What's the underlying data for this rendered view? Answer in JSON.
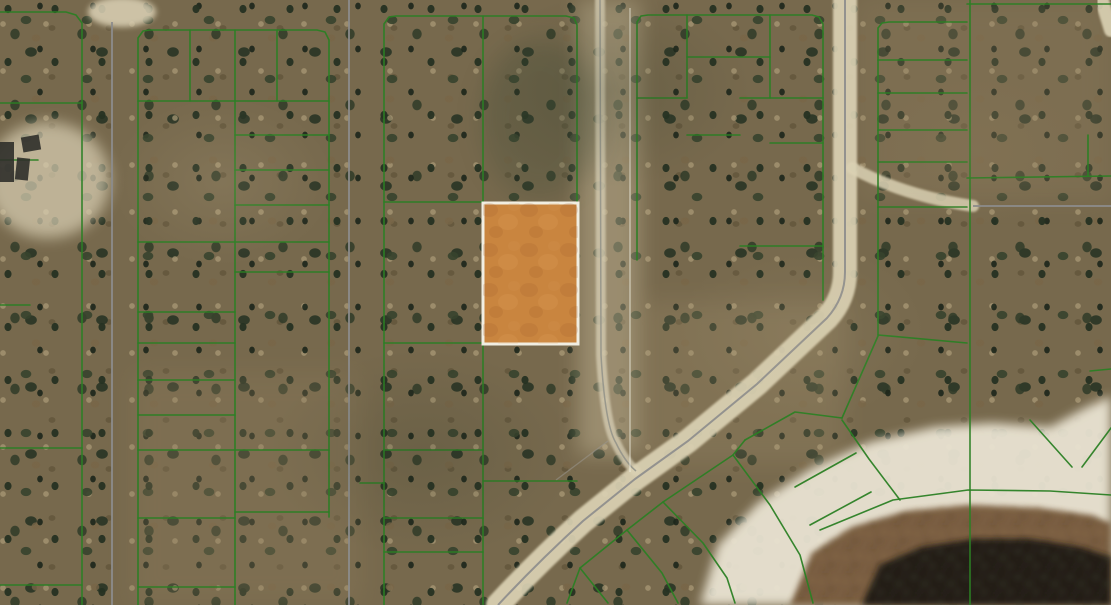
{
  "meta": {
    "view": "aerial-parcel-map",
    "description": "Satellite aerial view of a wooded subdivision with green platted lot boundaries, dirt roads, one orange highlighted parcel, and a dark pond at lower right",
    "width": 1111,
    "height": 605
  },
  "colors": {
    "parcel_line": "#2b7f24",
    "road_fill": "#dbd2b4",
    "road_centerline": "#8c8c8c",
    "highlight_fill": "#c9853f",
    "highlight_border": "#f1eee2",
    "sand": "#e9e3d2",
    "marsh": "#75593a",
    "pond": "#211c14",
    "section_line": "rgba(240,238,226,0.55)",
    "building": "#2f2f2a"
  },
  "map": {
    "highlight_parcel": {
      "x": 483,
      "y": 203,
      "width": 95,
      "height": 141,
      "fill": "#c9853f",
      "border": "#f1eee2",
      "border_width": 3,
      "texture": "tex-orange"
    },
    "terrain_zones": [
      {
        "shape": "ellipse",
        "cx": 48,
        "cy": 180,
        "rx": 62,
        "ry": 58,
        "fill": "#dcd2b6",
        "opacity": 0.7,
        "blur": 7
      },
      {
        "shape": "ellipse",
        "cx": 122,
        "cy": 12,
        "rx": 34,
        "ry": 15,
        "fill": "#dcd2b6",
        "opacity": 0.85,
        "blur": 3
      },
      {
        "shape": "rect",
        "x": 578,
        "y": 0,
        "w": 62,
        "h": 455,
        "fill": "#cfc2a2",
        "opacity": 0.4,
        "blur": 10
      },
      {
        "shape": "rect",
        "x": 132,
        "y": 372,
        "w": 230,
        "h": 233,
        "fill": "#8d7c5c",
        "opacity": 0.3,
        "blur": 12
      },
      {
        "shape": "rect",
        "x": 858,
        "y": 0,
        "w": 253,
        "h": 200,
        "fill": "#8f7e5f",
        "opacity": 0.26,
        "blur": 12
      },
      {
        "shape": "rect",
        "x": 640,
        "y": 300,
        "w": 205,
        "h": 165,
        "fill": "#a4936f",
        "opacity": 0.22,
        "blur": 12
      },
      {
        "shape": "ellipse",
        "cx": 540,
        "cy": 120,
        "rx": 60,
        "ry": 80,
        "fill": "#3c4a34",
        "opacity": 0.25,
        "blur": 12
      }
    ],
    "water_features": [
      {
        "name": "beach-sand",
        "points": "700,605 718,545 758,503 812,468 870,442 935,427 992,423 1050,427 1085,408 1111,396 1111,605",
        "fill": "#e9e3d2",
        "opacity": 0.95,
        "blur": 5
      },
      {
        "name": "marsh-ring",
        "points": "790,605 812,553 852,527 906,511 970,505 1040,508 1090,515 1111,523 1111,605",
        "fill": "#75593a",
        "opacity": 0.95,
        "blur": 3,
        "texture": "tex-marsh"
      },
      {
        "name": "pond-water",
        "points": "862,605 880,565 922,547 975,539 1030,539 1080,547 1111,557 1111,605",
        "fill": "#211c14",
        "opacity": 0.97,
        "blur": 3,
        "texture": "tex-pond"
      }
    ],
    "roads": {
      "bands": [
        {
          "name": "top-road",
          "d": "M 95,6 L 880,6",
          "w": 14
        },
        {
          "name": "left-road",
          "d": "M 113,0 L 113,605",
          "w": 24
        },
        {
          "name": "second-road",
          "d": "M 349,0 L 349,605",
          "w": 22
        },
        {
          "name": "trail-road",
          "d": "M 600,0 L 601,355 Q 605,425 616,443 Q 625,462 636,471",
          "w": 10,
          "color": "#d3cab0",
          "opacity": 0.8
        },
        {
          "name": "right-diagonal-road",
          "d": "M 845,0 L 845,272 Q 845,298 827,318 L 757,384 L 688,441 L 635,479 L 583,521 Q 538,562 498,605",
          "w": 24
        },
        {
          "name": "east-road",
          "d": "M 973,206 L 1111,206",
          "w": 16
        },
        {
          "name": "road-connector",
          "d": "M 852,168 Q 905,196 973,206",
          "w": 12,
          "opacity": 0.85
        },
        {
          "name": "corner-stub",
          "d": "M 1100,-6 Q 1106,14 1111,30",
          "w": 14,
          "opacity": 0.9
        }
      ],
      "centerlines": [
        {
          "d": "M 112,22 L 112,605",
          "w": 2
        },
        {
          "d": "M 349,0 L 349,605",
          "w": 2
        },
        {
          "d": "M 600,0 L 601,355 Q 605,425 616,443 Q 625,462 636,471",
          "w": 1.5,
          "color": "#93938a"
        },
        {
          "d": "M 845,0 L 845,272 Q 845,298 827,318 L 757,384 L 688,441 L 635,479 L 583,521 Q 538,562 498,605",
          "w": 2
        },
        {
          "d": "M 973,206 L 1111,206",
          "w": 2
        },
        {
          "d": "M 608,441 L 556,480",
          "w": 1.3,
          "color": "#9a9890",
          "opacity": 0.55
        }
      ]
    },
    "section_line": {
      "x": 630,
      "y1": 8,
      "y2": 472,
      "w": 1.5
    },
    "parcel_lines": [
      [
        [
          0,
          12
        ],
        [
          66,
          12
        ],
        [
          76,
          15
        ],
        [
          82,
          23
        ],
        [
          82,
          605
        ]
      ],
      [
        [
          0,
          103
        ],
        [
          82,
          103
        ]
      ],
      [
        [
          0,
          160
        ],
        [
          38,
          160
        ]
      ],
      [
        [
          0,
          305
        ],
        [
          30,
          305
        ]
      ],
      [
        [
          0,
          448
        ],
        [
          82,
          448
        ]
      ],
      [
        [
          0,
          585
        ],
        [
          82,
          585
        ]
      ],
      [
        [
          138,
          605
        ],
        [
          138,
          38
        ],
        [
          143,
          31
        ],
        [
          150,
          30
        ],
        [
          317,
          30
        ],
        [
          325,
          32
        ],
        [
          329,
          40
        ],
        [
          329,
          517
        ]
      ],
      [
        [
          235,
          30
        ],
        [
          235,
          605
        ]
      ],
      [
        [
          190,
          30
        ],
        [
          190,
          101
        ]
      ],
      [
        [
          277,
          30
        ],
        [
          277,
          101
        ]
      ],
      [
        [
          138,
          101
        ],
        [
          329,
          101
        ]
      ],
      [
        [
          235,
          135
        ],
        [
          329,
          135
        ]
      ],
      [
        [
          235,
          170
        ],
        [
          329,
          170
        ]
      ],
      [
        [
          235,
          205
        ],
        [
          329,
          205
        ]
      ],
      [
        [
          138,
          242
        ],
        [
          329,
          242
        ]
      ],
      [
        [
          235,
          272
        ],
        [
          329,
          272
        ]
      ],
      [
        [
          138,
          312
        ],
        [
          235,
          312
        ]
      ],
      [
        [
          138,
          343
        ],
        [
          235,
          343
        ]
      ],
      [
        [
          138,
          380
        ],
        [
          235,
          380
        ]
      ],
      [
        [
          138,
          415
        ],
        [
          235,
          415
        ]
      ],
      [
        [
          138,
          450
        ],
        [
          329,
          450
        ]
      ],
      [
        [
          235,
          512
        ],
        [
          329,
          512
        ]
      ],
      [
        [
          138,
          518
        ],
        [
          235,
          518
        ]
      ],
      [
        [
          138,
          587
        ],
        [
          235,
          587
        ]
      ],
      [
        [
          384,
          605
        ],
        [
          384,
          24
        ],
        [
          389,
          17
        ],
        [
          396,
          16
        ],
        [
          566,
          16
        ],
        [
          574,
          18
        ],
        [
          577,
          25
        ],
        [
          577,
          203
        ]
      ],
      [
        [
          483,
          16
        ],
        [
          483,
          203
        ]
      ],
      [
        [
          483,
          344
        ],
        [
          483,
          605
        ]
      ],
      [
        [
          384,
          202
        ],
        [
          483,
          202
        ]
      ],
      [
        [
          384,
          343
        ],
        [
          483,
          343
        ]
      ],
      [
        [
          384,
          450
        ],
        [
          483,
          450
        ]
      ],
      [
        [
          483,
          481
        ],
        [
          577,
          481
        ]
      ],
      [
        [
          384,
          518
        ],
        [
          483,
          518
        ]
      ],
      [
        [
          384,
          552
        ],
        [
          483,
          552
        ]
      ],
      [
        [
          360,
          483
        ],
        [
          384,
          483
        ]
      ],
      [
        [
          637,
          260
        ],
        [
          637,
          22
        ],
        [
          641,
          16
        ],
        [
          648,
          15
        ],
        [
          812,
          15
        ],
        [
          819,
          17
        ],
        [
          823,
          24
        ],
        [
          823,
          300
        ]
      ],
      [
        [
          687,
          15
        ],
        [
          687,
          98
        ]
      ],
      [
        [
          637,
          98
        ],
        [
          687,
          98
        ]
      ],
      [
        [
          687,
          57
        ],
        [
          770,
          57
        ]
      ],
      [
        [
          770,
          15
        ],
        [
          770,
          98
        ]
      ],
      [
        [
          740,
          98
        ],
        [
          823,
          98
        ]
      ],
      [
        [
          687,
          135
        ],
        [
          740,
          135
        ]
      ],
      [
        [
          770,
          143
        ],
        [
          823,
          143
        ]
      ],
      [
        [
          740,
          246
        ],
        [
          823,
          246
        ]
      ],
      [
        [
          878,
          335
        ],
        [
          878,
          28
        ],
        [
          882,
          23
        ],
        [
          889,
          22
        ],
        [
          967,
          22
        ]
      ],
      [
        [
          970,
          0
        ],
        [
          970,
          605
        ]
      ],
      [
        [
          878,
          60
        ],
        [
          967,
          60
        ]
      ],
      [
        [
          878,
          93
        ],
        [
          967,
          93
        ]
      ],
      [
        [
          878,
          130
        ],
        [
          967,
          130
        ]
      ],
      [
        [
          878,
          162
        ],
        [
          967,
          162
        ]
      ],
      [
        [
          878,
          207
        ],
        [
          967,
          207
        ]
      ],
      [
        [
          878,
          335
        ],
        [
          967,
          343
        ]
      ],
      [
        [
          967,
          4
        ],
        [
          1111,
          4
        ]
      ],
      [
        [
          967,
          178
        ],
        [
          1111,
          176
        ]
      ],
      [
        [
          1088,
          176
        ],
        [
          1088,
          135
        ]
      ],
      [
        [
          1090,
          371
        ],
        [
          1111,
          369
        ]
      ],
      [
        [
          1030,
          420
        ],
        [
          1072,
          467
        ]
      ],
      [
        [
          1111,
          428
        ],
        [
          1082,
          467
        ]
      ],
      [
        [
          900,
          500
        ],
        [
          869,
          459
        ],
        [
          842,
          420
        ]
      ],
      [
        [
          842,
          418
        ],
        [
          878,
          336
        ]
      ],
      [
        [
          842,
          418
        ],
        [
          795,
          412
        ],
        [
          745,
          440
        ]
      ],
      [
        [
          820,
          530
        ],
        [
          893,
          500
        ],
        [
          968,
          490
        ],
        [
          1050,
          491
        ],
        [
          1111,
          495
        ]
      ],
      [
        [
          745,
          440
        ],
        [
          733,
          455
        ],
        [
          663,
          502
        ],
        [
          627,
          530
        ],
        [
          580,
          568
        ],
        [
          567,
          603
        ]
      ],
      [
        [
          733,
          455
        ],
        [
          770,
          505
        ],
        [
          800,
          555
        ],
        [
          813,
          603
        ]
      ],
      [
        [
          663,
          502
        ],
        [
          703,
          543
        ],
        [
          727,
          578
        ],
        [
          735,
          603
        ]
      ],
      [
        [
          627,
          530
        ],
        [
          662,
          573
        ],
        [
          678,
          603
        ]
      ],
      [
        [
          580,
          568
        ],
        [
          608,
          603
        ]
      ],
      [
        [
          795,
          487
        ],
        [
          856,
          453
        ]
      ],
      [
        [
          810,
          525
        ],
        [
          871,
          492
        ]
      ]
    ],
    "buildings": [
      {
        "x": 0,
        "y": 142,
        "w": 14,
        "h": 40,
        "rot": 0
      },
      {
        "x": 22,
        "y": 136,
        "w": 18,
        "h": 15,
        "rot": -10
      },
      {
        "x": 16,
        "y": 158,
        "w": 13,
        "h": 22,
        "rot": 6
      }
    ]
  }
}
